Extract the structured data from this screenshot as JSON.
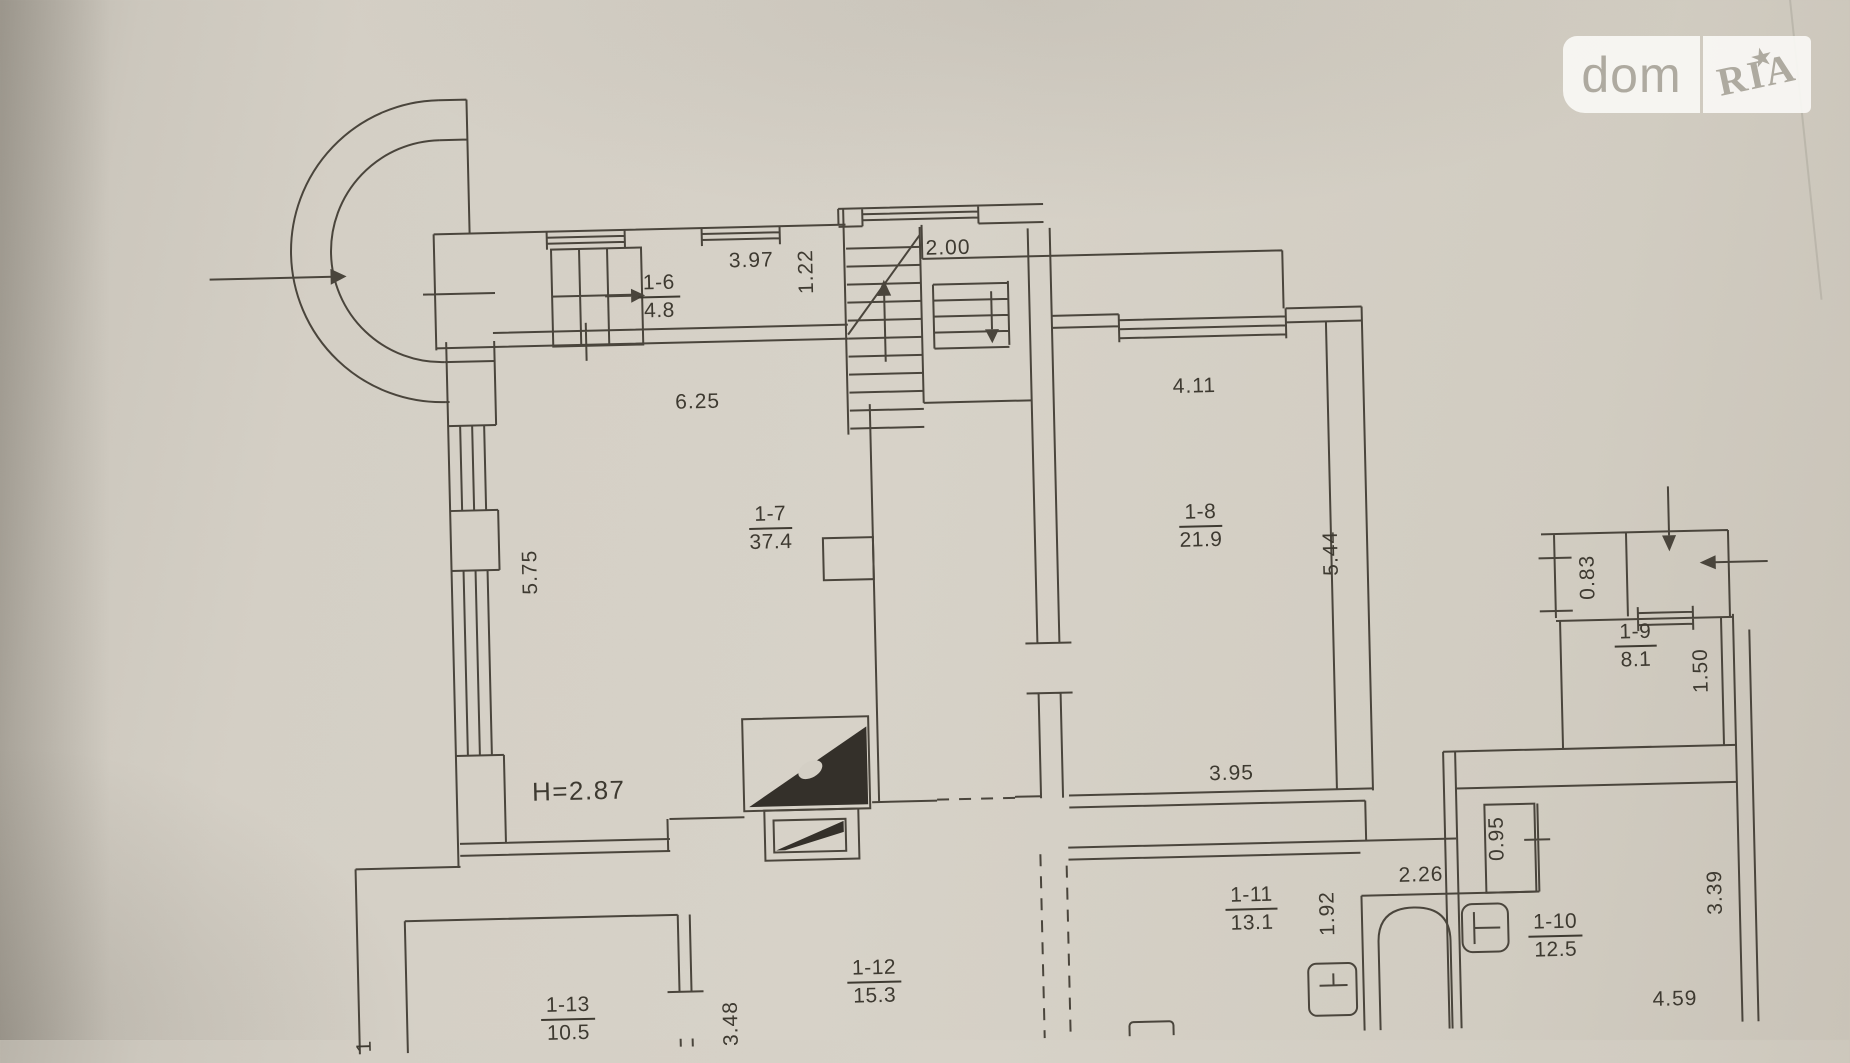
{
  "watermark": {
    "left": "dom",
    "right": "RIA",
    "star": "★"
  },
  "colors": {
    "ink": "#4a453c",
    "ink_fill": "#34302a",
    "text": "#3e3a31",
    "paper": "#d4cfc5",
    "watermark_text": "#aeaaa0"
  },
  "plan": {
    "rooms": [
      {
        "num": "1-6",
        "area": "4.8",
        "x": 664,
        "y": 290
      },
      {
        "num": "1-7",
        "area": "37.4",
        "x": 770,
        "y": 524
      },
      {
        "num": "1-8",
        "area": "21.9",
        "x": 1200,
        "y": 532
      },
      {
        "num": "1-9",
        "area": "8.1",
        "x": 1632,
        "y": 662
      },
      {
        "num": "1-10",
        "area": "12.5",
        "x": 1545,
        "y": 950
      },
      {
        "num": "1-11",
        "area": "13.1",
        "x": 1242,
        "y": 916
      },
      {
        "num": "1-12",
        "area": "15.3",
        "x": 863,
        "y": 980
      },
      {
        "num": "1-13",
        "area": "10.5",
        "x": 556,
        "y": 1010
      }
    ],
    "dims": [
      {
        "t": "3.97",
        "x": 757,
        "y": 256
      },
      {
        "t": "1.22",
        "x": 812,
        "y": 268,
        "rot": true
      },
      {
        "t": "2.00",
        "x": 954,
        "y": 248
      },
      {
        "t": "6.25",
        "x": 700,
        "y": 396
      },
      {
        "t": "5.75",
        "x": 529,
        "y": 562,
        "rot": true
      },
      {
        "t": "4.11",
        "x": 1197,
        "y": 392
      },
      {
        "t": "5.44",
        "x": 1330,
        "y": 562,
        "rot": true
      },
      {
        "t": "0.83",
        "x": 1586,
        "y": 592,
        "rot": true
      },
      {
        "t": "1-9",
        "x": 0,
        "y": 0,
        "hidden": true
      },
      {
        "t": "1.50",
        "x": 1697,
        "y": 688,
        "rot": true
      },
      {
        "t": "3.95",
        "x": 1225,
        "y": 780
      },
      {
        "t": "H=2.87",
        "x": 572,
        "y": 782,
        "big": true
      },
      {
        "t": "0.95",
        "x": 1489,
        "y": 851,
        "rot": true
      },
      {
        "t": "2.26",
        "x": 1412,
        "y": 886
      },
      {
        "t": "1.92",
        "x": 1318,
        "y": 922,
        "rot": true
      },
      {
        "t": "3.39",
        "x": 1706,
        "y": 910,
        "rot": true
      },
      {
        "t": "4.59",
        "x": 1663,
        "y": 1016
      },
      {
        "t": "3.48",
        "x": 719,
        "y": 1018,
        "rot": true
      },
      {
        "t": "1",
        "x": 352,
        "y": 1032,
        "rot": true
      }
    ],
    "height_note": "H=2.87"
  }
}
